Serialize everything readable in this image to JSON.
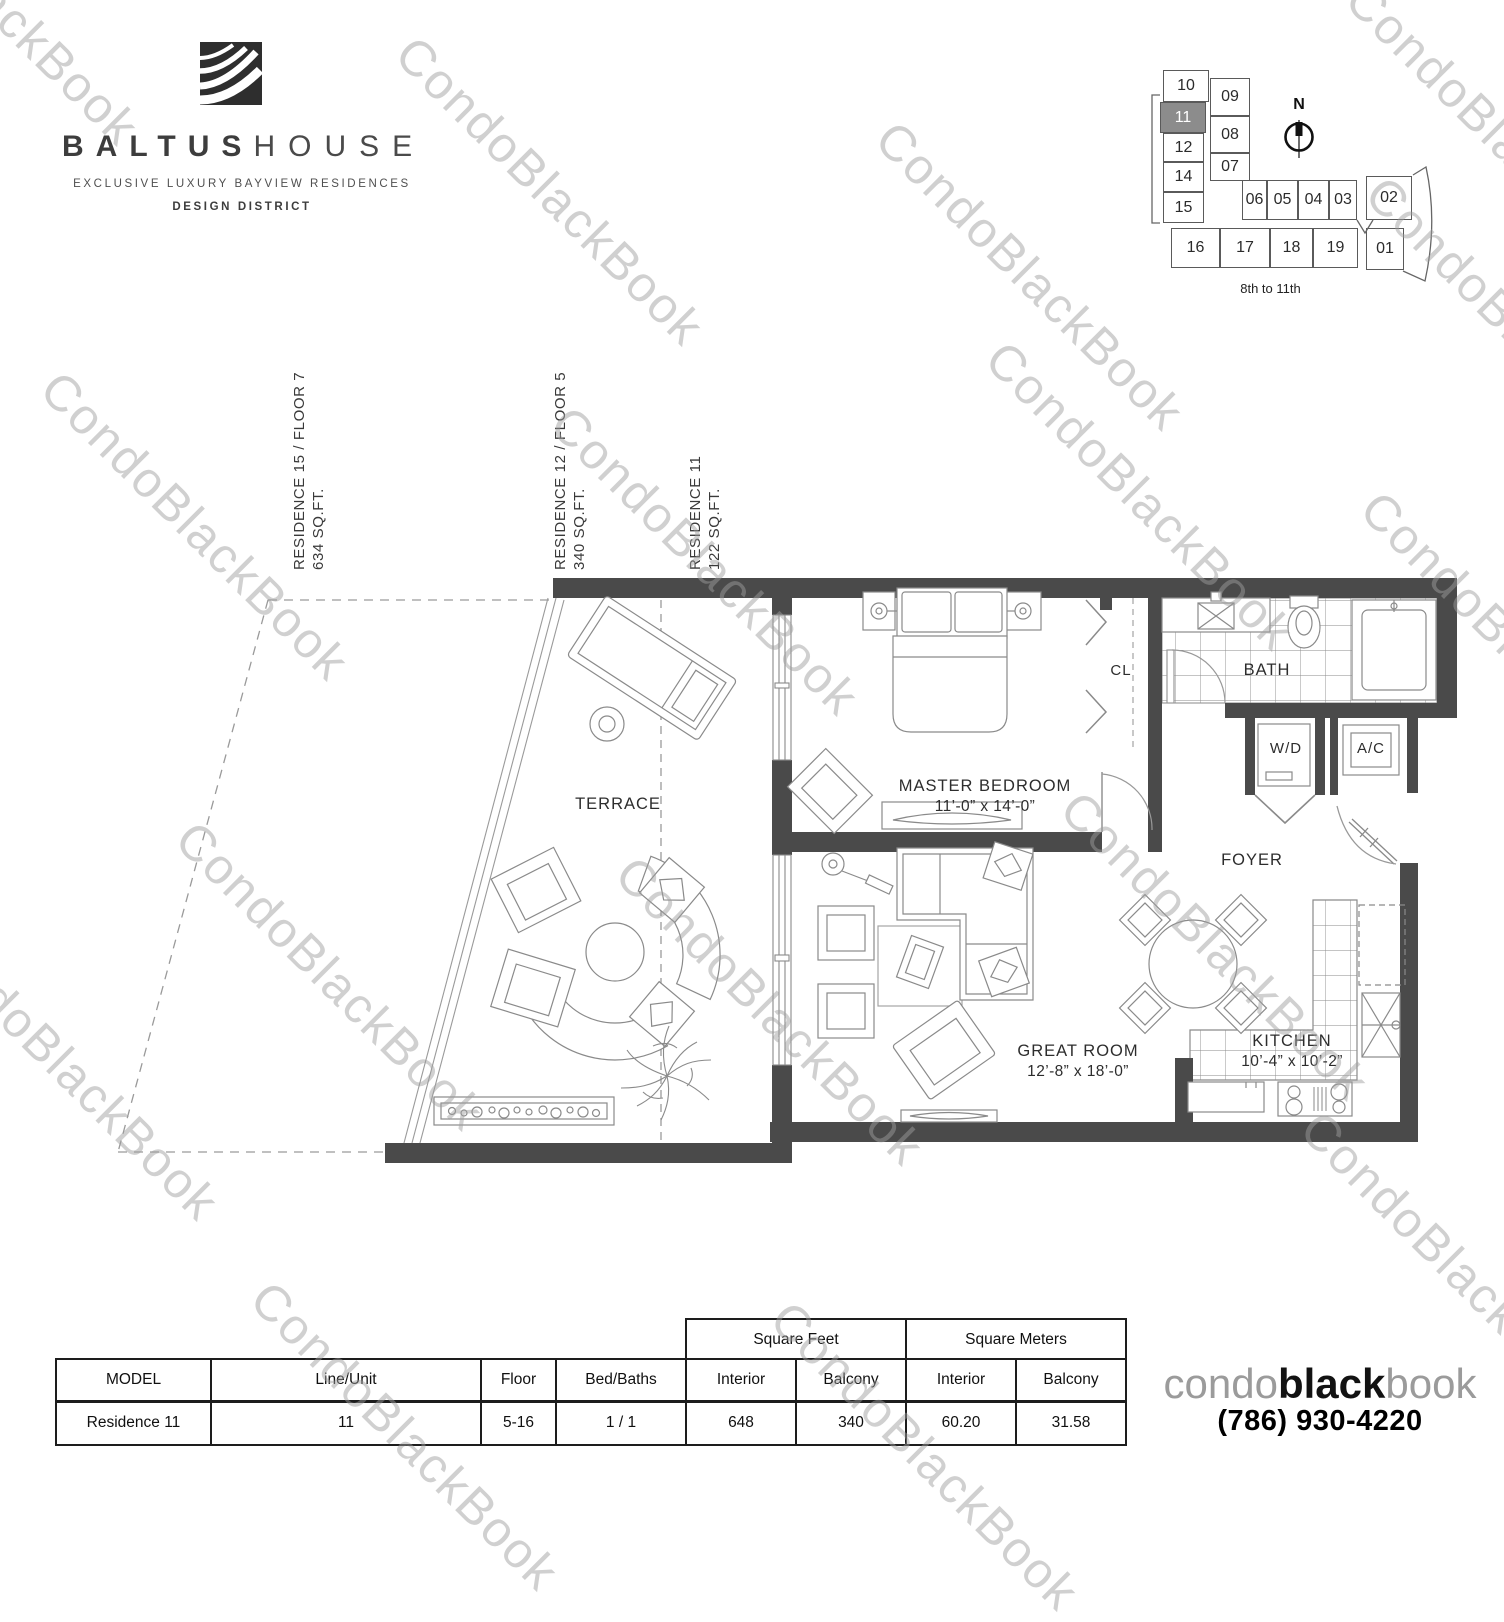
{
  "brand": {
    "name_bold": "BALTUS",
    "name_light": "HOUSE",
    "tagline": "EXCLUSIVE LUXURY BAYVIEW RESIDENCES",
    "subtitle": "DESIGN DISTRICT"
  },
  "keyplan": {
    "north_label": "N",
    "caption": "8th to 11th",
    "highlighted_unit": "11",
    "cells": [
      "10",
      "11",
      "12",
      "14",
      "15",
      "09",
      "08",
      "07",
      "06",
      "05",
      "04",
      "03",
      "02",
      "16",
      "17",
      "18",
      "19",
      "01"
    ]
  },
  "side_labels": [
    {
      "line1": "RESIDENCE 15 / FLOOR 7",
      "line2": "634 SQ.FT."
    },
    {
      "line1": "RESIDENCE 12 / FLOOR 5",
      "line2": "340 SQ.FT."
    },
    {
      "line1": "RESIDENCE 11",
      "line2": "122 SQ.FT."
    }
  ],
  "rooms": {
    "terrace": "TERRACE",
    "master_bedroom": {
      "name": "MASTER BEDROOM",
      "dims": "11’-0” x 14’-0”"
    },
    "closet": "CL",
    "bath": "BATH",
    "wd": "W/D",
    "ac": "A/C",
    "foyer": "FOYER",
    "great_room": {
      "name": "GREAT ROOM",
      "dims": "12’-8” x 18’-0”"
    },
    "kitchen": {
      "name": "KITCHEN",
      "dims": "10’-4” x 10’-2”"
    }
  },
  "table": {
    "group_headers": [
      "Square Feet",
      "Square Meters"
    ],
    "columns": [
      "MODEL",
      "Line/Unit",
      "Floor",
      "Bed/Baths",
      "Interior",
      "Balcony",
      "Interior",
      "Balcony"
    ],
    "rows": [
      [
        "Residence 11",
        "11",
        "5-16",
        "1 / 1",
        "648",
        "340",
        "60.20",
        "31.58"
      ]
    ]
  },
  "footer": {
    "logo_condo": "condo",
    "logo_black": "black",
    "logo_book": "book",
    "phone": "(786) 930-4220"
  },
  "watermark": {
    "text": "CondoBlackBook"
  },
  "colors": {
    "wall": "#4a4a4a",
    "furniture_line": "#8a8a8a",
    "highlight_cell": "#8c8c8c",
    "watermark": "#cdcdcd"
  }
}
